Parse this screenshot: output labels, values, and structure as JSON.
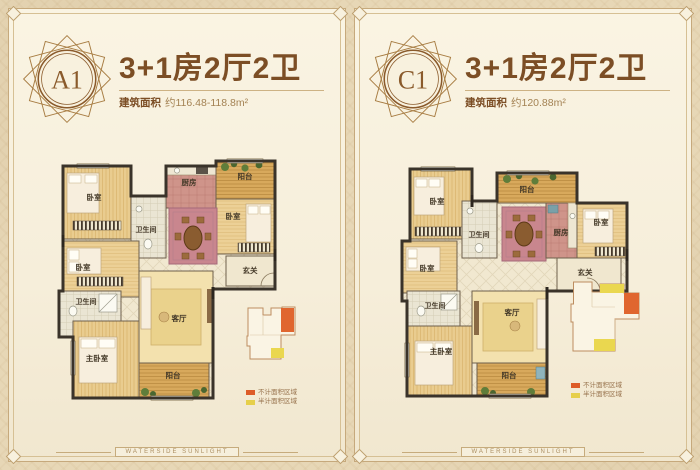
{
  "page": {
    "footer_ribbon_text": "WATERSIDE SUNLIGHT",
    "colors": {
      "page_background": "#e7d7b6",
      "panel_background": "#f8f1de",
      "accent_brown": "#7c4e25",
      "badge_ring": "#8a5a2b",
      "wall": "#3a332a",
      "legend_orange": "#dd5c28",
      "legend_yellow": "#e6cf4a"
    }
  },
  "panels": [
    {
      "badge_label": "A1",
      "title": "3+1房2厅2卫",
      "area_prefix": "建筑面积",
      "area_value": "约116.48-118.8m²",
      "rooms": {
        "bedroom_top_left": "卧室",
        "bathroom_upper": "卫生间",
        "kitchen": "厨房",
        "balcony_top": "阳台",
        "bedroom_right": "卧室",
        "hall": "玄关",
        "bedroom_mid_left": "卧室",
        "bathroom_lower": "卫生间",
        "master_bedroom": "主卧室",
        "living_room": "客厅",
        "balcony_bottom": "阳台"
      },
      "legend": [
        {
          "color": "#dd5c28",
          "label": "不计面积区域"
        },
        {
          "color": "#e6cf4a",
          "label": "半计面积区域"
        }
      ]
    },
    {
      "badge_label": "C1",
      "title": "3+1房2厅2卫",
      "area_prefix": "建筑面积",
      "area_value": "约120.88m²",
      "rooms": {
        "bedroom_top_left": "卧室",
        "bathroom_upper": "卫生间",
        "kitchen": "厨房",
        "balcony_top": "阳台",
        "bedroom_right": "卧室",
        "hall": "玄关",
        "bedroom_mid_left": "卧室",
        "bathroom_lower": "卫生间",
        "master_bedroom": "主卧室",
        "living_room": "客厅",
        "balcony_bottom": "阳台"
      },
      "legend": [
        {
          "color": "#dd5c28",
          "label": "不计面积区域"
        },
        {
          "color": "#e6cf4a",
          "label": "半计面积区域"
        }
      ]
    }
  ]
}
